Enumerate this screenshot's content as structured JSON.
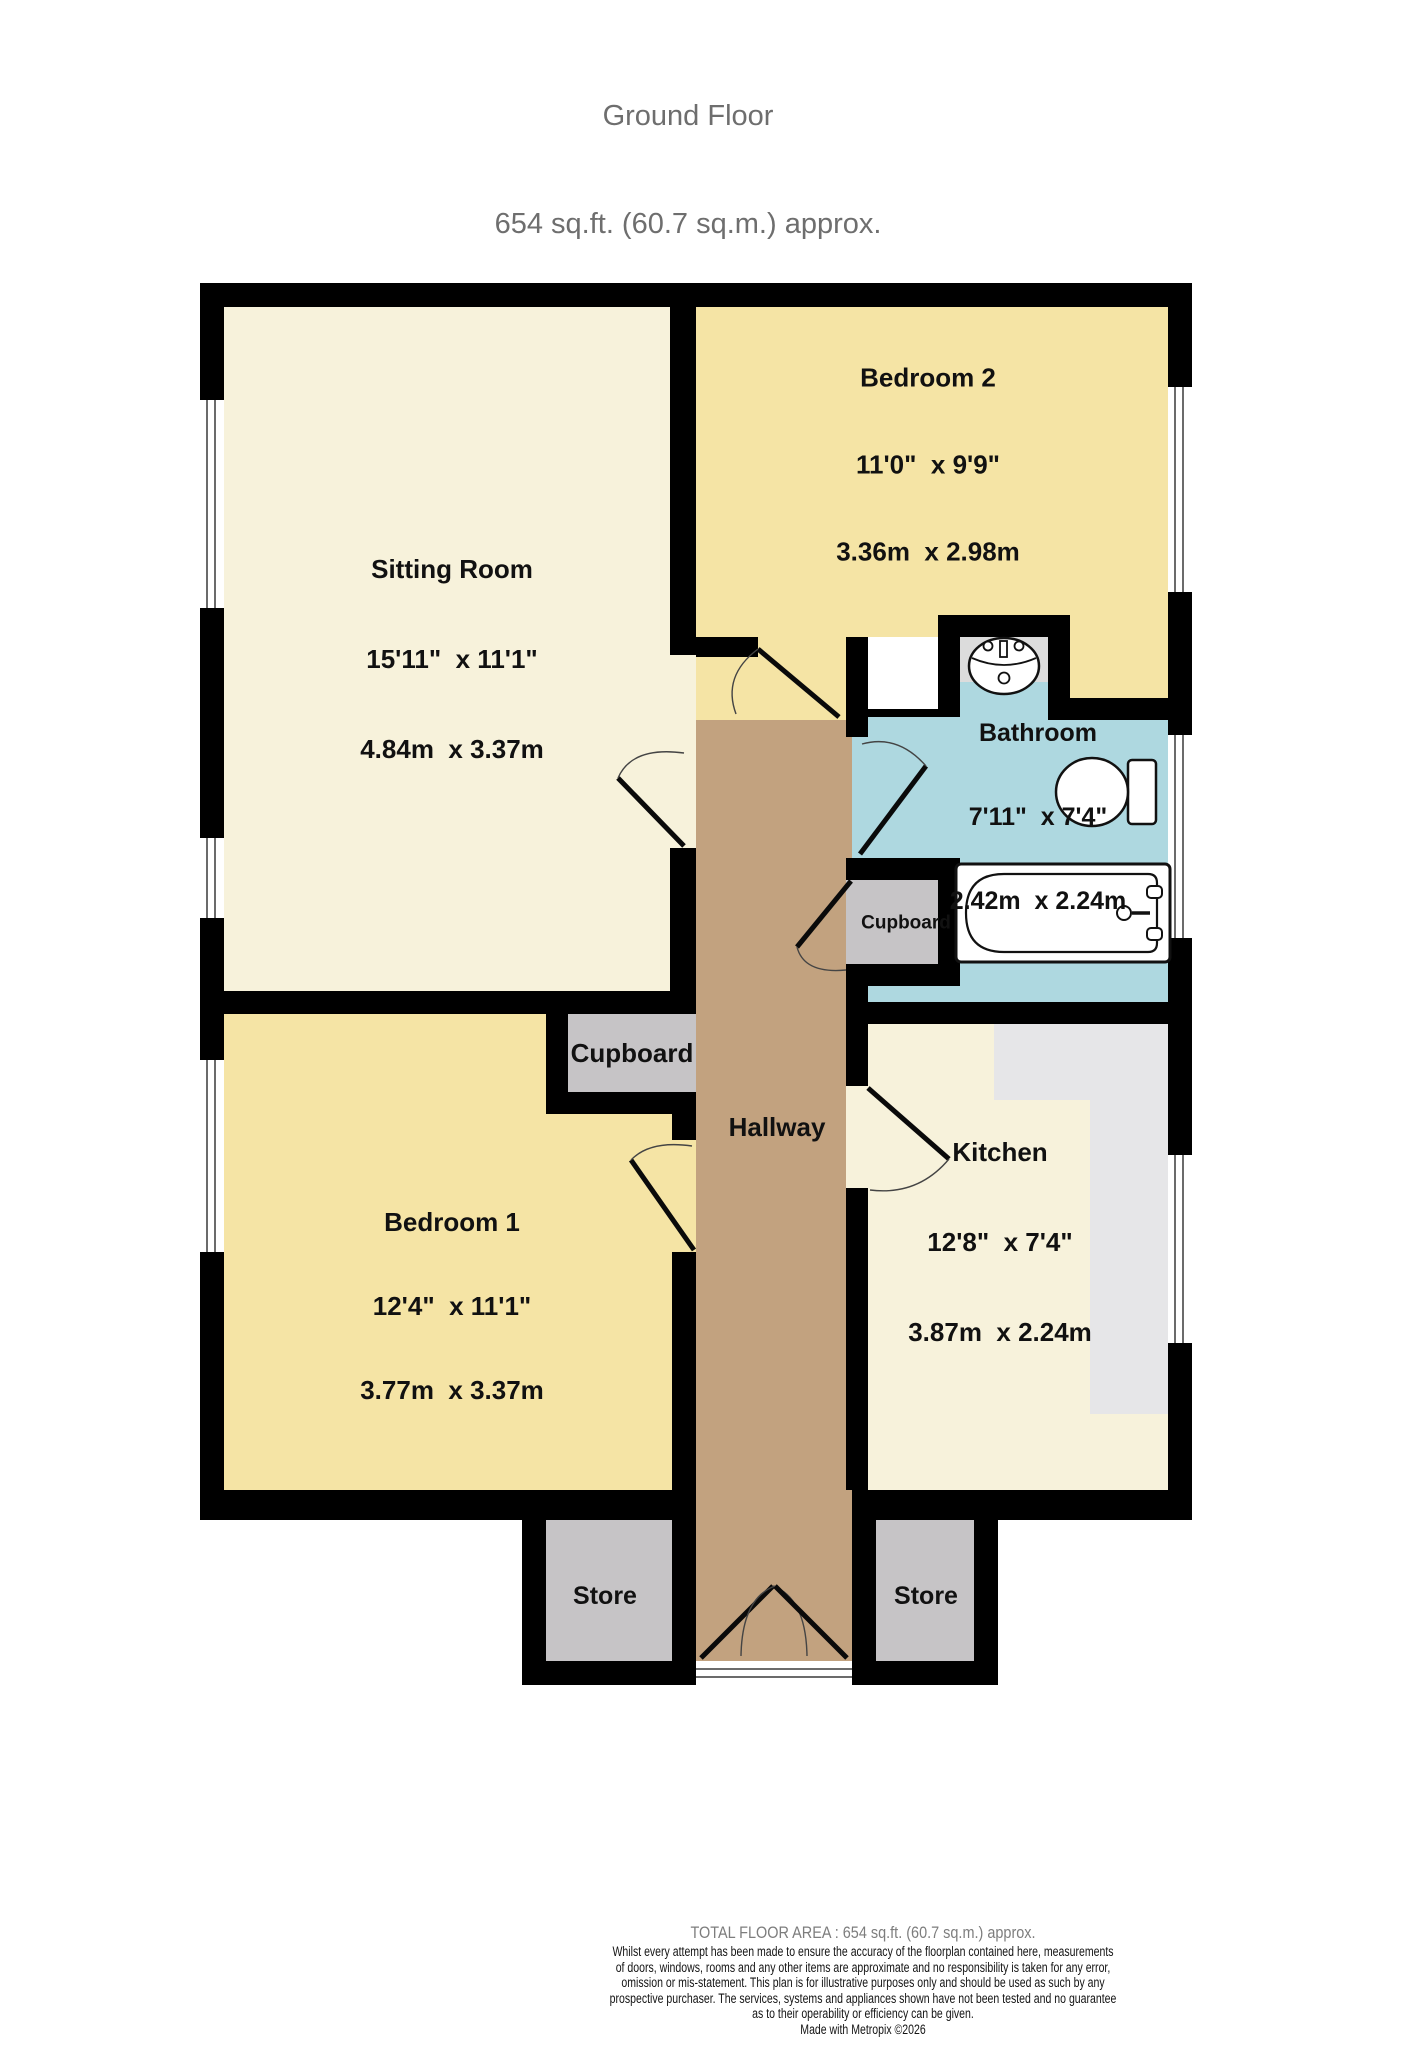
{
  "title": {
    "line1": "Ground Floor",
    "line2": "654 sq.ft. (60.7 sq.m.) approx."
  },
  "rooms": {
    "sitting_room": {
      "name": "Sitting Room",
      "dims_imperial": "15'11\"  x 11'1\"",
      "dims_metric": "4.84m  x 3.37m"
    },
    "bedroom2": {
      "name": "Bedroom 2",
      "dims_imperial": "11'0\"  x 9'9\"",
      "dims_metric": "3.36m  x 2.98m"
    },
    "bathroom": {
      "name": "Bathroom",
      "dims_imperial": "7'11\"  x 7'4\"",
      "dims_metric": "2.42m  x 2.24m"
    },
    "bedroom1": {
      "name": "Bedroom 1",
      "dims_imperial": "12'4\"  x 11'1\"",
      "dims_metric": "3.77m  x 3.37m"
    },
    "kitchen": {
      "name": "Kitchen",
      "dims_imperial": "12'8\"  x 7'4\"",
      "dims_metric": "3.87m  x 2.24m"
    },
    "hallway": {
      "name": "Hallway"
    },
    "cupboard_large": {
      "name": "Cupboard"
    },
    "cupboard_small": {
      "name": "Cupboard"
    },
    "store_left": {
      "name": "Store"
    },
    "store_right": {
      "name": "Store"
    }
  },
  "icons": {
    "sink": "sink-icon",
    "toilet": "toilet-icon",
    "bathtub": "bathtub-icon",
    "window": "window-glyph",
    "door": "door-swing-arc"
  },
  "footer": {
    "total": "TOTAL FLOOR AREA : 654 sq.ft. (60.7 sq.m.) approx.",
    "disclaimer_lines": [
      "Whilst every attempt has been made to ensure the accuracy of the floorplan contained here, measurements",
      "of doors, windows, rooms and any other items are approximate and no responsibility is taken for any error,",
      "omission or mis-statement. This plan is for illustrative purposes only and should be used as such by any",
      "prospective purchaser. The services, systems and appliances shown have not been tested and no guarantee",
      "as to their operability or efficiency can be given.",
      "Made with Metropix ©2026"
    ]
  },
  "colors": {
    "wall": "#000000",
    "bedroom_fill": "#f5e4a5",
    "living_fill": "#f7f2db",
    "hallway_fill": "#c2a27f",
    "bathroom_fill": "#aed8e0",
    "storage_fill": "#c6c4c6",
    "counter_fill": "#e6e6e8",
    "sink_alcove_fill": "#dcdcdc",
    "title_text": "#6e6e6e",
    "footer_muted": "#7d7d7d",
    "label_text": "#111111"
  }
}
